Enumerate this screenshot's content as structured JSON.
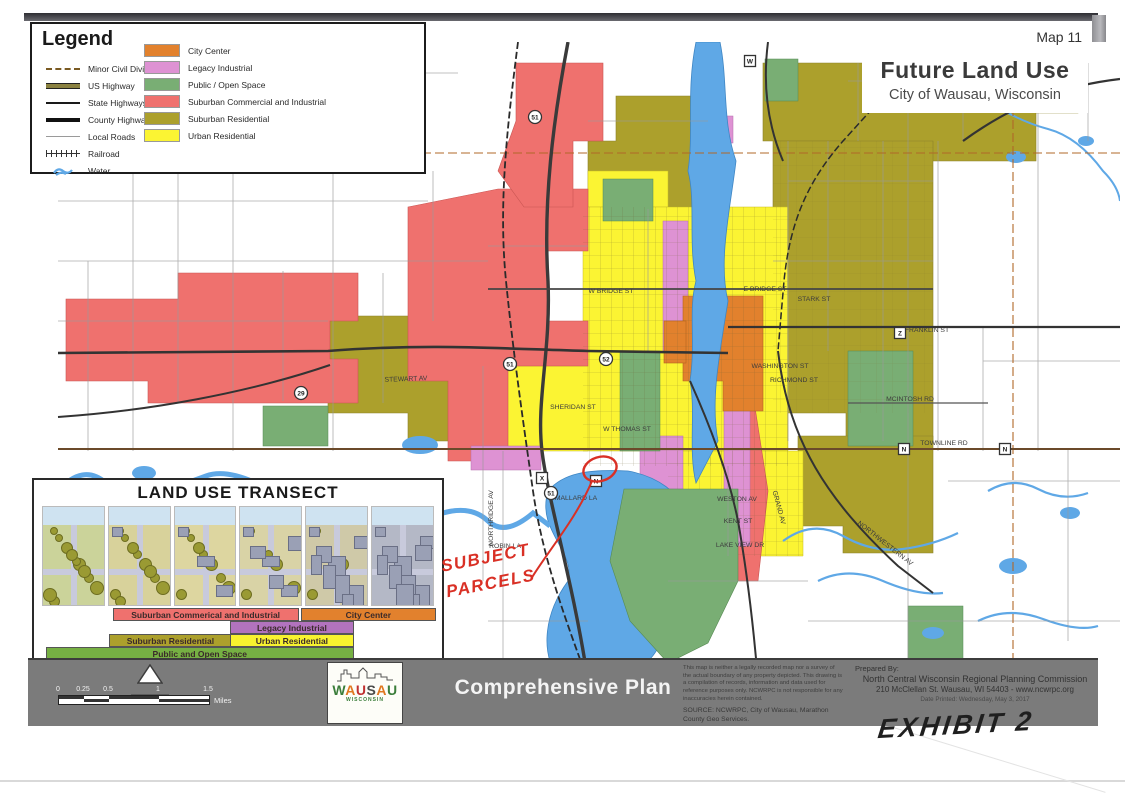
{
  "page": {
    "map_number": "Map 11",
    "title": "Future Land Use",
    "subtitle": "City of Wausau, Wisconsin"
  },
  "legend": {
    "title": "Legend",
    "line_items": [
      {
        "label": "Minor Civil Divisions",
        "kind": "mcd"
      },
      {
        "label": "US Highway",
        "kind": "us"
      },
      {
        "label": "State Highways",
        "kind": "state"
      },
      {
        "label": "County Highways",
        "kind": "county"
      },
      {
        "label": "Local Roads",
        "kind": "local"
      },
      {
        "label": "Railroad",
        "kind": "rail"
      },
      {
        "label": "Water",
        "kind": "water"
      }
    ],
    "area_items": [
      {
        "label": "City Center",
        "color": "#E2812D"
      },
      {
        "label": "Legacy Industrial",
        "color": "#DE92D3"
      },
      {
        "label": "Public / Open Space",
        "color": "#79AE74"
      },
      {
        "label": "Suburban Commercial and Industrial",
        "color": "#EF716E"
      },
      {
        "label": "Suburban Residential",
        "color": "#ACA02C"
      },
      {
        "label": "Urban Residential",
        "color": "#FBF433"
      }
    ]
  },
  "transect": {
    "title": "LAND USE TRANSECT",
    "bars": [
      {
        "row": 1,
        "label": "Suburban Commerical and Industrial",
        "color": "#EF716E",
        "left": 18,
        "width": 47
      },
      {
        "row": 1,
        "label": "City Center",
        "color": "#E2812D",
        "left": 66,
        "width": 34
      },
      {
        "row": 2,
        "label": "Legacy Industrial",
        "color": "#B273BE",
        "left": 48,
        "width": 31
      },
      {
        "row": 3,
        "label": "Suburban Residential",
        "color": "#ACA02C",
        "left": 17,
        "width": 31
      },
      {
        "row": 3,
        "label": "Urban Residential",
        "color": "#F8F32F",
        "left": 48,
        "width": 31
      },
      {
        "row": 4,
        "label": "Public and Open Space",
        "color": "#76B043",
        "left": 1,
        "width": 78
      }
    ]
  },
  "map": {
    "street_labels": [
      {
        "t": "DECATOR DR",
        "x": 347,
        "y": 49,
        "r": 0
      },
      {
        "t": "W BRIDGE ST",
        "x": 583,
        "y": 272,
        "r": 0
      },
      {
        "t": "E BRIDGE ST",
        "x": 737,
        "y": 270,
        "r": 0
      },
      {
        "t": "STARK ST",
        "x": 786,
        "y": 280,
        "r": 0
      },
      {
        "t": "FRANKLIN ST",
        "x": 899,
        "y": 311,
        "r": 0
      },
      {
        "t": "STEWART AV",
        "x": 378,
        "y": 360,
        "r": -2
      },
      {
        "t": "WASHINGTON ST",
        "x": 752,
        "y": 347,
        "r": 0
      },
      {
        "t": "RICHMOND ST",
        "x": 766,
        "y": 361,
        "r": 0
      },
      {
        "t": "SHERIDAN ST",
        "x": 545,
        "y": 388,
        "r": 0
      },
      {
        "t": "W THOMAS ST",
        "x": 599,
        "y": 410,
        "r": 0
      },
      {
        "t": "MCINTOSH RD",
        "x": 882,
        "y": 380,
        "r": 0
      },
      {
        "t": "TOWNLINE RD",
        "x": 916,
        "y": 424,
        "r": 0
      },
      {
        "t": "MALLARD LA",
        "x": 548,
        "y": 479,
        "r": 0
      },
      {
        "t": "ROBIN LA",
        "x": 477,
        "y": 527,
        "r": 0
      },
      {
        "t": "WESTON AV",
        "x": 709,
        "y": 480,
        "r": 0
      },
      {
        "t": "KENT ST",
        "x": 710,
        "y": 502,
        "r": 0
      },
      {
        "t": "LAKE VIEW DR",
        "x": 712,
        "y": 526,
        "r": 0
      },
      {
        "t": "GRAND AV",
        "x": 749,
        "y": 487,
        "r": 75
      },
      {
        "t": "NORTHRIDGE AV",
        "x": 465,
        "y": 497,
        "r": -90
      },
      {
        "t": "NORTHWESTERN AV",
        "x": 856,
        "y": 524,
        "r": 38
      }
    ],
    "shields": [
      {
        "t": "51",
        "s": "c",
        "x": 507,
        "y": 96
      },
      {
        "t": "51",
        "s": "c",
        "x": 482,
        "y": 343
      },
      {
        "t": "52",
        "s": "c",
        "x": 578,
        "y": 338
      },
      {
        "t": "29",
        "s": "c",
        "x": 273,
        "y": 372
      },
      {
        "t": "51",
        "s": "c",
        "x": 523,
        "y": 472
      },
      {
        "t": "W",
        "s": "q",
        "x": 722,
        "y": 40
      },
      {
        "t": "Z",
        "s": "q",
        "x": 1022,
        "y": 62
      },
      {
        "t": "Z",
        "s": "q",
        "x": 872,
        "y": 312
      },
      {
        "t": "N",
        "s": "q",
        "x": 876,
        "y": 428
      },
      {
        "t": "N",
        "s": "q",
        "x": 977,
        "y": 428
      },
      {
        "t": "X",
        "s": "q",
        "x": 514,
        "y": 457
      },
      {
        "t": "N",
        "s": "q",
        "x": 568,
        "y": 460
      }
    ]
  },
  "annotations": {
    "subject_line1": "SUBJECT",
    "subject_line2": "PARCELS",
    "exhibit": "EXHIBIT 2",
    "ink_color": "#D93025"
  },
  "footer": {
    "north_label": "NORTH",
    "scale_ticks": [
      {
        "t": "0",
        "x": 0
      },
      {
        "t": "0.25",
        "x": 25
      },
      {
        "t": "0.5",
        "x": 50
      },
      {
        "t": "1",
        "x": 100
      },
      {
        "t": "1.5",
        "x": 150
      }
    ],
    "scale_unit": "Miles",
    "logo": {
      "letters": [
        {
          "c": "W",
          "color": "#3a7d3a"
        },
        {
          "c": "A",
          "color": "#e07820"
        },
        {
          "c": "U",
          "color": "#c03030"
        },
        {
          "c": "S",
          "color": "#4a4a4a"
        },
        {
          "c": "A",
          "color": "#e07820"
        },
        {
          "c": "U",
          "color": "#3a7d3a"
        }
      ],
      "sub": "WISCONSIN"
    },
    "plan_title": "Comprehensive Plan",
    "disclaimer": "This map is neither a legally recorded map nor a survey of the actual boundary of any property depicted. This drawing is a compilation of records, information and data used for reference purposes only. NCWRPC is not responsible for any inaccuracies herein contained.",
    "source": "SOURCE: NCWRPC, City of Wausau, Marathon County Geo Services.",
    "prepared_by_label": "Prepared By:",
    "prepared_by": "North Central Wisconsin Regional Planning Commission",
    "address": "210 McClellan St.  Wausau, WI 54403 - www.ncwrpc.org",
    "date_printed": "Date Printed: Wednesday, May 3, 2017"
  },
  "colors": {
    "city_center": "#E2812D",
    "legacy_industrial": "#DE92D3",
    "public_open_space": "#79AE74",
    "suburban_commercial": "#EF716E",
    "suburban_residential": "#ACA02C",
    "urban_residential": "#FBF433",
    "water": "#5FA8E6",
    "footer_bar": "#7B7B7B"
  }
}
